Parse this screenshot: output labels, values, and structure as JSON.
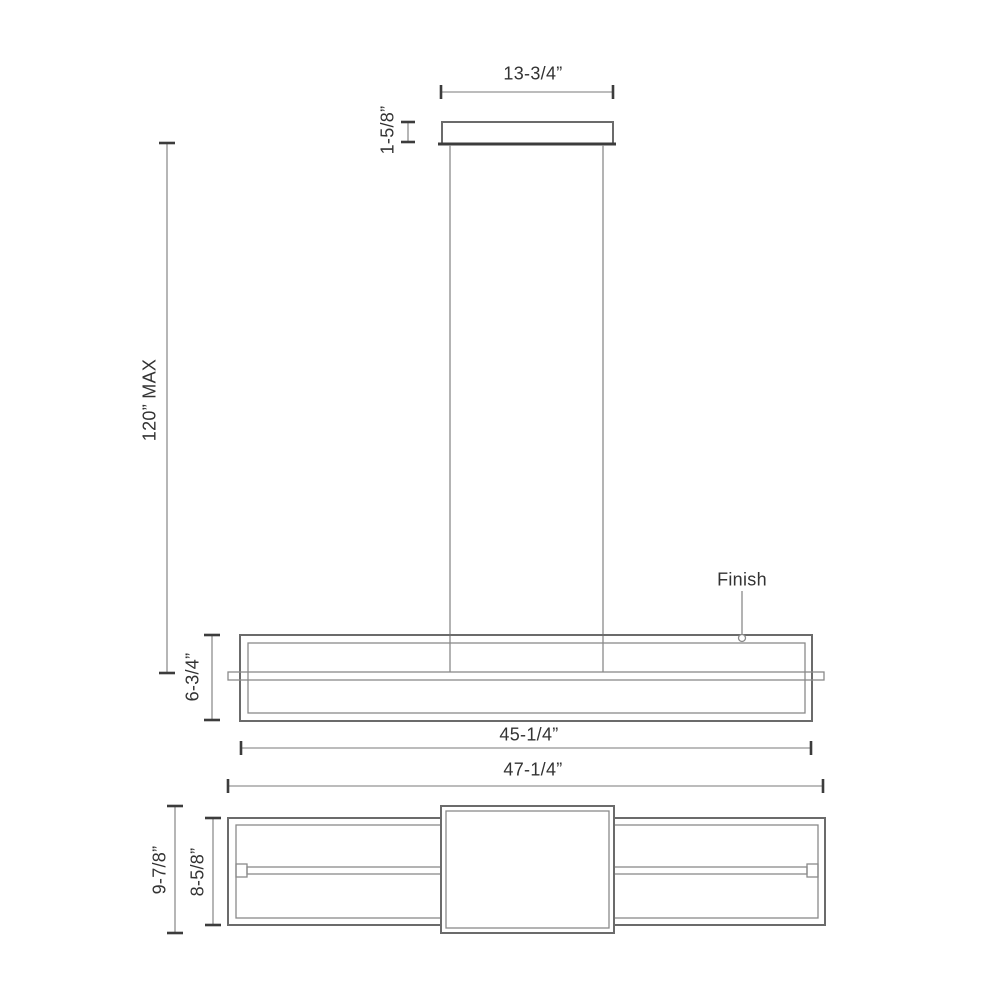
{
  "diagram": {
    "kind": "pendant-light-dimension-drawing",
    "views": {
      "front": {
        "dims": {
          "canopy_width": "13-3/4”",
          "canopy_height": "1-5/8”",
          "max_drop": "120” MAX",
          "fixture_height": "6-3/4”",
          "body_length": "45-1/4”",
          "overall_length": "47-1/4”"
        },
        "callouts": {
          "finish": "Finish"
        }
      },
      "bottom": {
        "dims": {
          "overall_depth": "9-7/8”",
          "body_depth": "8-5/8”"
        }
      }
    },
    "colors": {
      "background": "#ffffff",
      "line": "#8a8a8a",
      "outline": "#6b6b6b",
      "tick": "#3c3c3c",
      "text": "#333333"
    }
  }
}
